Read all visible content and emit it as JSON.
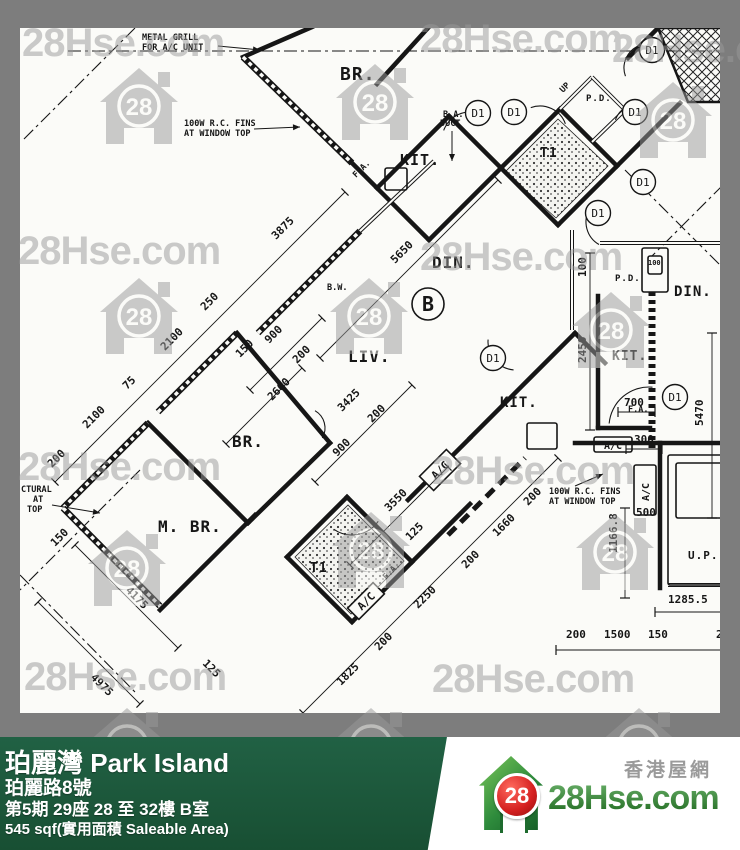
{
  "frame": {
    "bg": "#7d7d7d",
    "paper": "#fbfbf8",
    "ink": "#161616"
  },
  "watermark": {
    "text": "28Hse.com",
    "logo_number": "28",
    "color": "#999999",
    "opacity": 0.5,
    "text_positions": [
      [
        22,
        56
      ],
      [
        420,
        52
      ],
      [
        612,
        62
      ],
      [
        18,
        264
      ],
      [
        420,
        270
      ],
      [
        18,
        480
      ],
      [
        432,
        484
      ],
      [
        24,
        690
      ],
      [
        432,
        692
      ]
    ],
    "logo_positions": [
      [
        100,
        66
      ],
      [
        336,
        62
      ],
      [
        634,
        80
      ],
      [
        100,
        276
      ],
      [
        330,
        276
      ],
      [
        572,
        290
      ],
      [
        88,
        528
      ],
      [
        332,
        510
      ],
      [
        576,
        512
      ],
      [
        88,
        706
      ],
      [
        332,
        706
      ],
      [
        600,
        706
      ]
    ]
  },
  "plan": {
    "walls": [
      [
        312,
        27,
        243,
        57
      ],
      [
        428,
        28,
        377,
        84
      ],
      [
        352,
        163,
        377,
        188
      ],
      [
        377,
        188,
        449,
        116
      ],
      [
        449,
        116,
        501,
        168
      ],
      [
        501,
        168,
        429,
        240
      ],
      [
        429,
        240,
        377,
        188
      ],
      [
        501,
        168,
        560,
        109
      ],
      [
        560,
        109,
        617,
        166
      ],
      [
        617,
        166,
        558,
        225
      ],
      [
        558,
        225,
        501,
        168
      ],
      [
        617,
        166,
        680,
        103
      ],
      [
        628,
        58,
        658,
        28
      ],
      [
        237,
        333,
        330,
        443
      ],
      [
        148,
        423,
        248,
        523
      ],
      [
        248,
        523,
        330,
        443
      ],
      [
        160,
        610,
        255,
        515
      ],
      [
        287,
        557,
        347,
        497
      ],
      [
        347,
        497,
        412,
        562
      ],
      [
        412,
        562,
        352,
        622
      ],
      [
        352,
        622,
        287,
        557
      ],
      [
        412,
        562,
        470,
        504
      ],
      [
        408,
        500,
        470,
        438
      ],
      [
        470,
        438,
        575,
        333
      ],
      [
        575,
        333,
        605,
        363
      ],
      [
        660,
        443,
        660,
        588
      ],
      [
        575,
        443,
        740,
        443
      ],
      [
        598,
        296,
        598,
        428
      ],
      [
        598,
        428,
        650,
        428
      ]
    ],
    "double_walls": [
      [
        360,
        231,
        434,
        161
      ],
      [
        572,
        230,
        572,
        330
      ],
      [
        600,
        243,
        740,
        243
      ],
      [
        668,
        585,
        740,
        585
      ],
      [
        560,
        109,
        592,
        77
      ],
      [
        592,
        77,
        625,
        110
      ],
      [
        625,
        110,
        592,
        142
      ]
    ],
    "windows": [
      [
        243,
        57,
        352,
        163
      ],
      [
        258,
        333,
        360,
        231
      ],
      [
        158,
        412,
        237,
        333
      ],
      [
        63,
        508,
        148,
        423
      ],
      [
        63,
        508,
        160,
        606
      ]
    ],
    "dash_lines": [
      [
        68,
        51,
        740,
        51
      ],
      [
        135,
        28,
        22,
        141
      ],
      [
        140,
        470,
        20,
        590
      ],
      [
        20,
        575,
        135,
        692
      ],
      [
        625,
        170,
        740,
        285
      ],
      [
        740,
        168,
        652,
        256
      ]
    ],
    "heavy_dash": [
      [
        448,
        535,
        525,
        458
      ]
    ],
    "dotted_wall": [
      652,
      292,
      652,
      448
    ],
    "hatch_polygon": [
      [
        658,
        28
      ],
      [
        740,
        28
      ],
      [
        740,
        102
      ],
      [
        688,
        102
      ]
    ],
    "stipple_polygons": [
      [
        [
          505,
          172
        ],
        [
          558,
          119
        ],
        [
          608,
          166
        ],
        [
          556,
          218
        ]
      ],
      [
        [
          295,
          557
        ],
        [
          348,
          505
        ],
        [
          404,
          561
        ],
        [
          351,
          614
        ]
      ]
    ],
    "boxes": [
      [
        594,
        437,
        38,
        15
      ],
      [
        634,
        465,
        22,
        50
      ],
      [
        642,
        248,
        26,
        44
      ],
      [
        648,
        256,
        14,
        18
      ],
      [
        385,
        168,
        22,
        22
      ],
      [
        527,
        423,
        30,
        26
      ],
      [
        668,
        455,
        70,
        130
      ],
      [
        676,
        463,
        54,
        55
      ]
    ],
    "rot_boxes": [
      {
        "x": 440,
        "y": 470,
        "w": 38,
        "h": 20,
        "r": -45,
        "t": "A/C"
      },
      {
        "x": 366,
        "y": 601,
        "w": 36,
        "h": 16,
        "r": -45,
        "t": "A/C"
      }
    ],
    "ac_box_labels": [
      "A/C",
      "A/C"
    ],
    "arcs": [
      [
        470,
        140,
        28,
        200,
        290
      ],
      [
        540,
        133,
        27,
        250,
        340
      ],
      [
        648,
        68,
        24,
        160,
        250
      ],
      [
        638,
        128,
        24,
        200,
        290
      ],
      [
        612,
        222,
        26,
        120,
        210
      ],
      [
        516,
        342,
        28,
        95,
        185
      ],
      [
        649,
        427,
        40,
        185,
        275
      ],
      [
        352,
        503,
        32,
        35,
        125
      ],
      [
        305,
        428,
        20,
        300,
        30
      ]
    ],
    "door_circles": [
      [
        478,
        113
      ],
      [
        514,
        112
      ],
      [
        652,
        50
      ],
      [
        635,
        112
      ],
      [
        643,
        182
      ],
      [
        598,
        213
      ],
      [
        493,
        358
      ],
      [
        675,
        397
      ]
    ],
    "door_label": "D1",
    "unit_circle": [
      428,
      304
    ],
    "unit_label": "B",
    "room_labels": [
      {
        "t": "BR.",
        "x": 340,
        "y": 80,
        "s": 18
      },
      {
        "t": "KIT.",
        "x": 400,
        "y": 165,
        "s": 15
      },
      {
        "t": "T1",
        "x": 540,
        "y": 157,
        "s": 13
      },
      {
        "t": "P.D.",
        "x": 586,
        "y": 101,
        "s": 9
      },
      {
        "t": "DIN.",
        "x": 432,
        "y": 268,
        "s": 16
      },
      {
        "t": "LIV.",
        "x": 348,
        "y": 362,
        "s": 16
      },
      {
        "t": "BR.",
        "x": 232,
        "y": 447,
        "s": 16
      },
      {
        "t": "M. BR.",
        "x": 158,
        "y": 532,
        "s": 16
      },
      {
        "t": "T1",
        "x": 310,
        "y": 572,
        "s": 13
      },
      {
        "t": "KIT.",
        "x": 500,
        "y": 407,
        "s": 14
      },
      {
        "t": "KIT.",
        "x": 612,
        "y": 360,
        "s": 13
      },
      {
        "t": "DIN.",
        "x": 674,
        "y": 296,
        "s": 14
      },
      {
        "t": "P.D.",
        "x": 615,
        "y": 281,
        "s": 9
      },
      {
        "t": "U.P.",
        "x": 688,
        "y": 559,
        "s": 11
      }
    ],
    "dim_lines": [
      [
        55,
        482,
        345,
        192
      ],
      [
        250,
        390,
        322,
        318
      ],
      [
        226,
        444,
        302,
        368
      ],
      [
        320,
        358,
        498,
        180
      ],
      [
        303,
        713,
        558,
        458
      ],
      [
        350,
        565,
        448,
        467
      ],
      [
        315,
        482,
        412,
        385
      ],
      [
        75,
        545,
        178,
        648
      ],
      [
        38,
        602,
        140,
        704
      ],
      [
        625,
        508,
        625,
        598
      ],
      [
        655,
        612,
        740,
        612
      ],
      [
        556,
        650,
        740,
        650
      ],
      [
        712,
        333,
        712,
        518
      ],
      [
        590,
        253,
        590,
        430
      ],
      [
        618,
        412,
        655,
        412
      ],
      [
        626,
        449,
        662,
        449
      ]
    ],
    "dim_labels": [
      {
        "t": "3875",
        "x": 276,
        "y": 240,
        "r": -45
      },
      {
        "t": "250",
        "x": 205,
        "y": 311,
        "r": -45
      },
      {
        "t": "2100",
        "x": 165,
        "y": 351,
        "r": -45
      },
      {
        "t": "75",
        "x": 127,
        "y": 390,
        "r": -45
      },
      {
        "t": "2100",
        "x": 87,
        "y": 429,
        "r": -45
      },
      {
        "t": "900",
        "x": 269,
        "y": 344,
        "r": -45
      },
      {
        "t": "200",
        "x": 297,
        "y": 364,
        "r": -45
      },
      {
        "t": "150",
        "x": 240,
        "y": 358,
        "r": -45
      },
      {
        "t": "2600",
        "x": 272,
        "y": 401,
        "r": -45
      },
      {
        "t": "5650",
        "x": 395,
        "y": 264,
        "r": -45
      },
      {
        "t": "3425",
        "x": 342,
        "y": 412,
        "r": -45
      },
      {
        "t": "1825",
        "x": 341,
        "y": 686,
        "r": -45
      },
      {
        "t": "200",
        "x": 379,
        "y": 651,
        "r": -45
      },
      {
        "t": "2250",
        "x": 418,
        "y": 609,
        "r": -45
      },
      {
        "t": "200",
        "x": 466,
        "y": 569,
        "r": -45
      },
      {
        "t": "1660",
        "x": 497,
        "y": 537,
        "r": -45
      },
      {
        "t": "200",
        "x": 528,
        "y": 506,
        "r": -45
      },
      {
        "t": "3550",
        "x": 389,
        "y": 512,
        "r": -45
      },
      {
        "t": "125",
        "x": 410,
        "y": 541,
        "r": -45
      },
      {
        "t": "900",
        "x": 337,
        "y": 457,
        "r": -45
      },
      {
        "t": "200",
        "x": 372,
        "y": 423,
        "r": -45
      },
      {
        "t": "4175",
        "x": 125,
        "y": 591,
        "r": 45
      },
      {
        "t": "4975",
        "x": 90,
        "y": 678,
        "r": 45
      },
      {
        "t": "125",
        "x": 202,
        "y": 664,
        "r": 45
      },
      {
        "t": "1166.8",
        "x": 617,
        "y": 553,
        "r": -90
      },
      {
        "t": "1285.5",
        "x": 668,
        "y": 603,
        "r": 0
      },
      {
        "t": "200",
        "x": 566,
        "y": 638,
        "r": 0
      },
      {
        "t": "1500",
        "x": 604,
        "y": 638,
        "r": 0
      },
      {
        "t": "150",
        "x": 648,
        "y": 638,
        "r": 0
      },
      {
        "t": "2",
        "x": 716,
        "y": 638,
        "r": 0
      },
      {
        "t": "5470",
        "x": 703,
        "y": 426,
        "r": -90
      },
      {
        "t": "2450",
        "x": 586,
        "y": 363,
        "r": -90
      },
      {
        "t": "100",
        "x": 586,
        "y": 277,
        "r": -90
      },
      {
        "t": "700",
        "x": 624,
        "y": 406,
        "r": 0
      },
      {
        "t": "300",
        "x": 634,
        "y": 443,
        "r": 0
      },
      {
        "t": "500",
        "x": 636,
        "y": 516,
        "r": 0
      },
      {
        "t": "100",
        "x": 648,
        "y": 265,
        "r": 0,
        "s": 7
      },
      {
        "t": "150",
        "x": 55,
        "y": 547,
        "r": -45
      },
      {
        "t": "200",
        "x": 52,
        "y": 468,
        "r": -45
      }
    ],
    "annotations": [
      {
        "t": "METAL GRILL",
        "x": 142,
        "y": 40
      },
      {
        "t": "FOR A/C UNIT",
        "x": 142,
        "y": 50
      },
      {
        "t": "100W R.C. FINS",
        "x": 184,
        "y": 126
      },
      {
        "t": "AT WINDOW TOP",
        "x": 184,
        "y": 136
      },
      {
        "t": "100W R.C. FINS",
        "x": 549,
        "y": 494
      },
      {
        "t": "AT WINDOW TOP",
        "x": 549,
        "y": 504
      },
      {
        "t": "B.A.",
        "x": 443,
        "y": 117
      },
      {
        "t": "DUCT",
        "x": 440,
        "y": 126
      },
      {
        "t": "B.W.",
        "x": 327,
        "y": 290
      },
      {
        "t": "CTURAL",
        "x": 21,
        "y": 492
      },
      {
        "t": "AT",
        "x": 33,
        "y": 502
      },
      {
        "t": "TOP",
        "x": 27,
        "y": 512
      },
      {
        "t": "UP",
        "x": 563,
        "y": 93,
        "r": -45
      },
      {
        "t": "F.A.",
        "x": 356,
        "y": 178,
        "r": -45
      },
      {
        "t": "F.A.",
        "x": 386,
        "y": 580,
        "r": -45
      },
      {
        "t": "F.A.",
        "x": 628,
        "y": 412
      }
    ],
    "arrows": [
      [
        218,
        46,
        260,
        50
      ],
      [
        254,
        129,
        300,
        127
      ],
      [
        575,
        486,
        603,
        474
      ],
      [
        452,
        131,
        452,
        161
      ],
      [
        52,
        505,
        100,
        513
      ]
    ]
  },
  "footer": {
    "bg": "#1d5c38",
    "title": "珀麗灣 Park Island",
    "address": "珀麗路8號",
    "block": "第5期 29座 28 至 32樓 B室",
    "area": "545 sqf(實用面積 Saleable Area)",
    "logo": {
      "number": "28",
      "site": "28Hse.com",
      "tagline": "香港屋網"
    }
  }
}
